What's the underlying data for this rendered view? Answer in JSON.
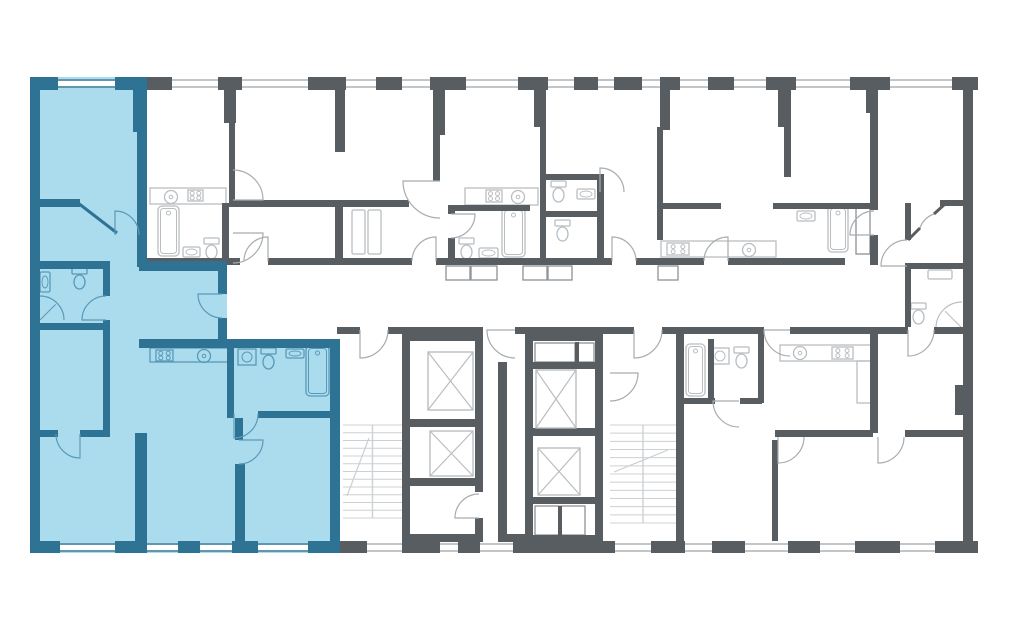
{
  "canvas": {
    "width": 1024,
    "height": 632
  },
  "colors": {
    "page_background": "#ffffff",
    "room_white": "#ffffff",
    "wall_gray": "#585d61",
    "wall_blue": "#2f7394",
    "highlight_fill": "#abdcee",
    "fixture_gray": "#b9bec1",
    "fixture_blue": "#5999b8",
    "door_gray": "#a7acaf",
    "door_blue": "#5999b8",
    "window_gray": "#aeb3b6",
    "stair_gray": "#ccd0d3",
    "outline_gray": "#8d9296"
  },
  "highlight": {
    "meaning": "selected-apartment",
    "fill_regions": [
      [
        30,
        77,
        117,
        476
      ],
      [
        139,
        261,
        88,
        86
      ],
      [
        139,
        339,
        201,
        214
      ]
    ]
  },
  "walls_gray": [
    [
      147,
      77,
      25,
      13
    ],
    [
      218,
      77,
      24,
      13
    ],
    [
      308,
      77,
      38,
      13
    ],
    [
      376,
      77,
      26,
      13
    ],
    [
      430,
      77,
      36,
      13
    ],
    [
      518,
      77,
      30,
      13
    ],
    [
      574,
      77,
      24,
      13
    ],
    [
      614,
      77,
      28,
      13
    ],
    [
      660,
      77,
      20,
      13
    ],
    [
      708,
      77,
      26,
      13
    ],
    [
      766,
      77,
      30,
      13
    ],
    [
      850,
      77,
      40,
      13
    ],
    [
      952,
      77,
      26,
      13
    ],
    [
      224,
      90,
      12,
      33
    ],
    [
      335,
      90,
      10,
      62
    ],
    [
      433,
      90,
      12,
      45
    ],
    [
      534,
      90,
      12,
      37
    ],
    [
      660,
      90,
      10,
      40
    ],
    [
      778,
      90,
      12,
      37
    ],
    [
      866,
      90,
      12,
      23
    ],
    [
      963,
      90,
      10,
      38
    ],
    [
      963,
      128,
      10,
      413
    ],
    [
      955,
      385,
      8,
      30
    ],
    [
      935,
      541,
      43,
      12
    ],
    [
      337,
      541,
      30,
      12
    ],
    [
      402,
      541,
      38,
      12
    ],
    [
      458,
      541,
      22,
      12
    ],
    [
      513,
      541,
      102,
      12
    ],
    [
      651,
      541,
      34,
      12
    ],
    [
      712,
      541,
      33,
      12
    ],
    [
      788,
      541,
      32,
      12
    ],
    [
      855,
      541,
      45,
      12
    ],
    [
      226,
      258,
      14,
      7
    ],
    [
      268,
      258,
      144,
      7
    ],
    [
      436,
      258,
      176,
      7
    ],
    [
      636,
      258,
      68,
      7
    ],
    [
      728,
      258,
      117,
      7
    ],
    [
      337,
      327,
      23,
      7
    ],
    [
      388,
      327,
      95,
      7
    ],
    [
      515,
      327,
      119,
      7
    ],
    [
      662,
      327,
      102,
      7
    ],
    [
      790,
      327,
      118,
      7
    ],
    [
      934,
      327,
      29,
      7
    ],
    [
      229,
      123,
      6,
      77
    ],
    [
      540,
      127,
      6,
      131
    ],
    [
      657,
      127,
      6,
      113
    ],
    [
      784,
      87,
      7,
      90
    ],
    [
      870,
      77,
      8,
      133
    ],
    [
      870,
      235,
      8,
      30
    ],
    [
      905,
      203,
      6,
      37
    ],
    [
      905,
      266,
      6,
      61
    ],
    [
      229,
      200,
      180,
      7
    ],
    [
      335,
      200,
      8,
      58
    ],
    [
      433,
      135,
      7,
      46
    ],
    [
      222,
      203,
      7,
      55
    ],
    [
      147,
      258,
      79,
      7
    ],
    [
      448,
      205,
      82,
      6
    ],
    [
      448,
      205,
      7,
      9
    ],
    [
      448,
      238,
      7,
      20
    ],
    [
      545,
      174,
      59,
      6
    ],
    [
      597,
      174,
      7,
      91
    ],
    [
      545,
      211,
      59,
      6
    ],
    [
      663,
      203,
      58,
      6
    ],
    [
      773,
      203,
      105,
      6
    ],
    [
      940,
      200,
      23,
      6
    ],
    [
      905,
      263,
      58,
      6
    ],
    [
      870,
      333,
      8,
      100
    ],
    [
      905,
      430,
      58,
      7
    ],
    [
      708,
      339,
      6,
      62
    ],
    [
      758,
      333,
      6,
      70
    ],
    [
      684,
      398,
      31,
      6
    ],
    [
      740,
      398,
      22,
      6
    ],
    [
      775,
      430,
      98,
      7
    ],
    [
      772,
      440,
      6,
      101
    ],
    [
      402,
      333,
      81,
      8
    ],
    [
      402,
      341,
      8,
      200
    ],
    [
      475,
      341,
      8,
      151
    ],
    [
      475,
      518,
      8,
      16
    ],
    [
      410,
      419,
      65,
      8
    ],
    [
      410,
      478,
      65,
      8
    ],
    [
      402,
      534,
      81,
      8
    ],
    [
      498,
      362,
      9,
      172
    ],
    [
      498,
      534,
      27,
      8
    ],
    [
      525,
      333,
      78,
      8
    ],
    [
      525,
      341,
      8,
      194
    ],
    [
      595,
      341,
      8,
      194
    ],
    [
      525,
      362,
      78,
      7
    ],
    [
      525,
      428,
      78,
      8
    ],
    [
      525,
      497,
      78,
      7
    ],
    [
      525,
      535,
      78,
      8
    ],
    [
      575,
      342,
      4,
      20
    ],
    [
      558,
      506,
      4,
      29
    ],
    [
      676,
      333,
      8,
      208
    ]
  ],
  "walls_blue": [
    [
      30,
      77,
      10,
      476
    ],
    [
      30,
      77,
      28,
      13
    ],
    [
      115,
      77,
      32,
      13
    ],
    [
      137,
      77,
      10,
      190
    ],
    [
      133,
      90,
      14,
      42
    ],
    [
      139,
      261,
      88,
      10
    ],
    [
      218,
      261,
      9,
      33
    ],
    [
      218,
      318,
      9,
      29
    ],
    [
      139,
      339,
      201,
      9
    ],
    [
      330,
      339,
      10,
      214
    ],
    [
      30,
      541,
      30,
      12
    ],
    [
      115,
      541,
      32,
      12
    ],
    [
      178,
      541,
      22,
      12
    ],
    [
      232,
      541,
      26,
      12
    ],
    [
      308,
      541,
      32,
      12
    ],
    [
      38,
      199,
      42,
      8
    ],
    [
      38,
      261,
      72,
      8
    ],
    [
      103,
      261,
      7,
      35
    ],
    [
      103,
      320,
      7,
      110
    ],
    [
      38,
      323,
      65,
      7
    ],
    [
      38,
      430,
      20,
      7
    ],
    [
      80,
      430,
      30,
      7
    ],
    [
      135,
      433,
      12,
      108
    ],
    [
      227,
      347,
      7,
      71
    ],
    [
      258,
      411,
      72,
      7
    ],
    [
      235,
      418,
      8,
      22
    ],
    [
      235,
      464,
      10,
      77
    ]
  ],
  "windows": [
    [
      172,
      79,
      46,
      "g"
    ],
    [
      242,
      79,
      66,
      "g"
    ],
    [
      346,
      79,
      30,
      "g"
    ],
    [
      402,
      79,
      28,
      "g"
    ],
    [
      466,
      79,
      52,
      "g"
    ],
    [
      548,
      79,
      26,
      "g"
    ],
    [
      598,
      79,
      16,
      "g"
    ],
    [
      642,
      79,
      18,
      "g"
    ],
    [
      680,
      79,
      28,
      "g"
    ],
    [
      734,
      79,
      32,
      "g"
    ],
    [
      796,
      79,
      54,
      "g"
    ],
    [
      890,
      79,
      62,
      "g"
    ],
    [
      367,
      543,
      35,
      "g"
    ],
    [
      440,
      543,
      18,
      "g"
    ],
    [
      480,
      543,
      33,
      "g"
    ],
    [
      615,
      543,
      36,
      "g"
    ],
    [
      685,
      543,
      27,
      "g"
    ],
    [
      745,
      543,
      43,
      "g"
    ],
    [
      820,
      543,
      35,
      "g"
    ],
    [
      900,
      543,
      35,
      "g"
    ],
    [
      58,
      79,
      57,
      "b"
    ],
    [
      60,
      543,
      55,
      "b"
    ],
    [
      147,
      543,
      31,
      "b"
    ],
    [
      200,
      543,
      32,
      "b"
    ],
    [
      258,
      543,
      50,
      "b"
    ]
  ],
  "diag_walls": [
    [
      78,
      203,
      117,
      233,
      "b"
    ],
    [
      908,
      240,
      920,
      228,
      "g"
    ],
    [
      934,
      214,
      945,
      204,
      "g"
    ]
  ],
  "doors": [
    {
      "d": "M 222 294 L 198 294 A 24 24 0 0 0 222 318",
      "c": "b"
    },
    {
      "d": "M 106 320 L 82 320 A 24 24 0 0 1 106 296",
      "c": "b"
    },
    {
      "d": "M 115 235 L 115 211 A 24 24 0 0 1 139 235",
      "c": "b"
    },
    {
      "d": "M 234 414 L 234 438 A 24 24 0 0 0 258 414",
      "c": "b"
    },
    {
      "d": "M 239 440 L 263 440 A 24 24 0 0 1 239 464",
      "c": "b"
    },
    {
      "d": "M 80 434 L 80 458 A 24 24 0 0 1 56 434",
      "c": "b"
    },
    {
      "d": "M 268 261 L 268 237 A 24 24 0 0 0 244 261",
      "c": "g"
    },
    {
      "d": "M 436 261 L 436 237 A 24 24 0 0 0 412 261",
      "c": "g"
    },
    {
      "d": "M 440 181 L 403 181 A 37 37 0 0 0 440 218",
      "c": "g"
    },
    {
      "d": "M 451 214 L 475 214 A 24 24 0 0 1 451 238",
      "c": "g"
    },
    {
      "d": "M 600 192 L 600 168 A 24 24 0 0 1 624 192",
      "c": "g"
    },
    {
      "d": "M 612 261 L 612 237 A 24 24 0 0 1 636 261",
      "c": "g"
    },
    {
      "d": "M 728 261 L 728 237 A 24 24 0 0 0 704 261",
      "c": "g"
    },
    {
      "d": "M 233 200 L 263 200 A 30 30 0 0 0 233 170",
      "c": "g"
    },
    {
      "d": "M 233 233 L 263 233 A 30 30 0 0 1 233 263",
      "c": "g"
    },
    {
      "d": "M 360 330 L 360 358 A 28 28 0 0 0 388 330",
      "c": "g"
    },
    {
      "d": "M 515 330 L 487 330 A 28 28 0 0 0 515 358",
      "c": "g"
    },
    {
      "d": "M 634 330 L 634 358 A 28 28 0 0 0 662 330",
      "c": "g"
    },
    {
      "d": "M 610 373 L 638 373 A 28 28 0 0 1 610 401",
      "c": "g"
    },
    {
      "d": "M 790 330 L 764 330 A 26 26 0 0 0 790 356",
      "c": "g"
    },
    {
      "d": "M 908 330 L 908 356 A 26 26 0 0 0 934 330",
      "c": "g"
    },
    {
      "d": "M 907 266 L 881 266 A 26 26 0 0 1 907 240",
      "c": "g"
    },
    {
      "d": "M 878 437 L 878 463 A 26 26 0 0 0 904 437",
      "c": "g"
    },
    {
      "d": "M 739 401 L 713 401 A 26 26 0 0 0 739 427",
      "c": "g"
    },
    {
      "d": "M 778 437 L 778 463 A 26 26 0 0 0 804 437",
      "c": "g"
    },
    {
      "d": "M 479 518 L 455 518 A 24 24 0 0 1 479 494",
      "c": "g"
    },
    {
      "d": "M 874 235 L 850 235 A 24 24 0 0 1 874 211",
      "c": "g"
    },
    {
      "d": "M 920 228 A 22 22 0 0 1 934 214",
      "c": "g"
    }
  ],
  "ducts": [
    [
      446,
      266,
      24,
      14
    ],
    [
      471,
      266,
      26,
      14
    ],
    [
      523,
      266,
      24,
      14
    ],
    [
      548,
      266,
      24,
      14
    ],
    [
      658,
      266,
      20,
      14
    ],
    [
      856,
      206,
      14,
      48
    ]
  ],
  "shaft_boxes": [
    [
      535,
      343,
      40,
      19
    ],
    [
      577,
      343,
      17,
      19
    ],
    [
      535,
      506,
      24,
      29
    ],
    [
      561,
      506,
      24,
      29
    ]
  ],
  "elevators": [
    [
      428,
      352,
      45,
      58
    ],
    [
      430,
      431,
      43,
      45
    ],
    [
      536,
      370,
      40,
      58
    ],
    [
      538,
      448,
      42,
      47
    ]
  ],
  "stairs": [
    {
      "x": 343,
      "y": 425,
      "w": 59,
      "h": 93,
      "arrow": [
        347,
        496,
        369,
        438
      ]
    },
    {
      "x": 610,
      "y": 425,
      "w": 66,
      "h": 98,
      "arrow": [
        614,
        472,
        668,
        450
      ]
    }
  ],
  "fixtures": [
    [
      "counter",
      150,
      188,
      76,
      16,
      "g"
    ],
    [
      "stove",
      188,
      190,
      15,
      11,
      "g"
    ],
    [
      "sinkc",
      171,
      197,
      0,
      0,
      "g"
    ],
    [
      "tub",
      158,
      206,
      21,
      50,
      "g"
    ],
    [
      "toilet",
      204,
      238,
      0,
      0,
      "g"
    ],
    [
      "sink",
      183,
      247,
      17,
      10,
      "g"
    ],
    [
      "shelf",
      352,
      210,
      13,
      44,
      "g"
    ],
    [
      "shelf",
      368,
      210,
      13,
      44,
      "g"
    ],
    [
      "counter",
      465,
      188,
      73,
      17,
      "g"
    ],
    [
      "stove",
      486,
      190,
      16,
      12,
      "g"
    ],
    [
      "sinkc",
      518,
      197,
      0,
      0,
      "g"
    ],
    [
      "tub",
      502,
      208,
      23,
      49,
      "g"
    ],
    [
      "toilet",
      459,
      238,
      0,
      0,
      "g"
    ],
    [
      "sink",
      479,
      248,
      19,
      10,
      "g"
    ],
    [
      "toilet",
      551,
      181,
      0,
      0,
      "g"
    ],
    [
      "sink",
      577,
      189,
      18,
      10,
      "g"
    ],
    [
      "toilet",
      555,
      220,
      0,
      0,
      "g"
    ],
    [
      "counter",
      661,
      241,
      115,
      16,
      "g"
    ],
    [
      "stove",
      667,
      243,
      22,
      12,
      "g"
    ],
    [
      "sinkc",
      749,
      250,
      0,
      0,
      "g"
    ],
    [
      "sink",
      797,
      211,
      18,
      10,
      "g"
    ],
    [
      "tub",
      828,
      206,
      20,
      46,
      "g"
    ],
    [
      "mirror",
      928,
      270,
      24,
      9,
      "g"
    ],
    [
      "toilet",
      911,
      303,
      0,
      0,
      "g"
    ],
    [
      "showerbr",
      936,
      302,
      26,
      0,
      "g"
    ],
    [
      "tub",
      686,
      344,
      19,
      52,
      "g"
    ],
    [
      "washer",
      711,
      348,
      0,
      0,
      "g"
    ],
    [
      "toilet",
      734,
      347,
      0,
      0,
      "g"
    ],
    [
      "counter",
      780,
      345,
      92,
      16,
      "g"
    ],
    [
      "sinkc",
      800,
      353,
      0,
      0,
      "g"
    ],
    [
      "stove",
      832,
      347,
      21,
      12,
      "g"
    ],
    [
      "counter",
      857,
      361,
      15,
      42,
      "g"
    ],
    [
      "counter",
      150,
      348,
      78,
      14,
      "b"
    ],
    [
      "stove",
      156,
      350,
      17,
      11,
      "b"
    ],
    [
      "sinkc",
      204,
      356,
      0,
      0,
      "b"
    ],
    [
      "sinkv",
      40,
      272,
      10,
      20,
      "b"
    ],
    [
      "toilet",
      72,
      268,
      0,
      0,
      "b"
    ],
    [
      "showerbl",
      40,
      296,
      24,
      0,
      "b"
    ],
    [
      "washer",
      238,
      349,
      0,
      0,
      "b"
    ],
    [
      "toilet",
      261,
      348,
      0,
      0,
      "b"
    ],
    [
      "sink",
      286,
      349,
      18,
      9,
      "b"
    ],
    [
      "tub",
      306,
      346,
      23,
      50,
      "b"
    ]
  ]
}
